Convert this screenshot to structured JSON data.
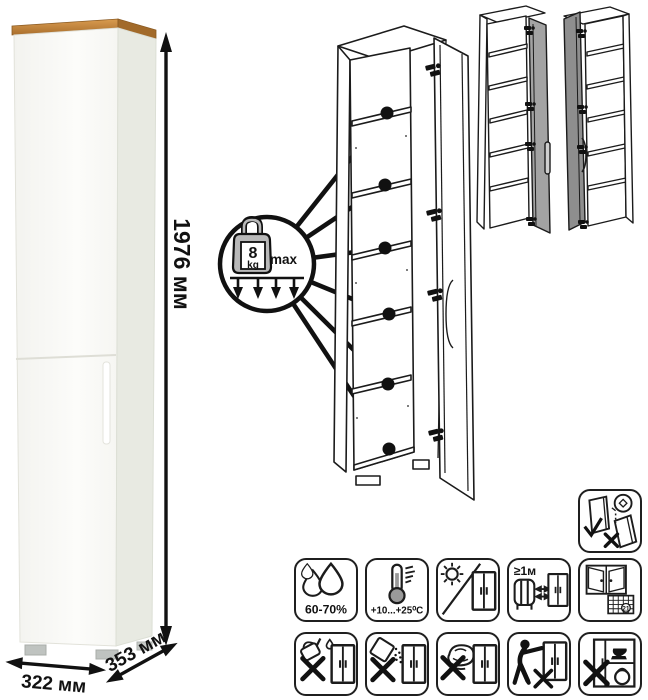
{
  "product": {
    "dimensions": {
      "height": "1976 мм",
      "width": "322 мм",
      "depth": "353 мм"
    },
    "shelf_load": {
      "value": "8",
      "unit": "kg",
      "qualifier": "max"
    }
  },
  "labels": {
    "humidity": "60-70%",
    "temperature": "+10...+25⁰C",
    "heat_distance": "≥1м",
    "calendar_day": "21"
  },
  "colors": {
    "wood_top": "#c08440",
    "cabinet_front": "#fbfbf8",
    "cabinet_side": "#e8eae2",
    "door_gray_right_variant": "#a3a3a3",
    "door_gray_left_variant": "#8e8e8e",
    "weight_gray": "#b9b9b9",
    "line_art": "#1b1b1b"
  },
  "icons": [
    "anchor-to-wall",
    "humidity",
    "temperature",
    "no-direct-sunlight",
    "heat-distance-1m",
    "ventilation-calendar",
    "no-liquids",
    "no-abrasive-powder",
    "no-wet-cloth",
    "no-dragging",
    "no-heavy-items"
  ]
}
